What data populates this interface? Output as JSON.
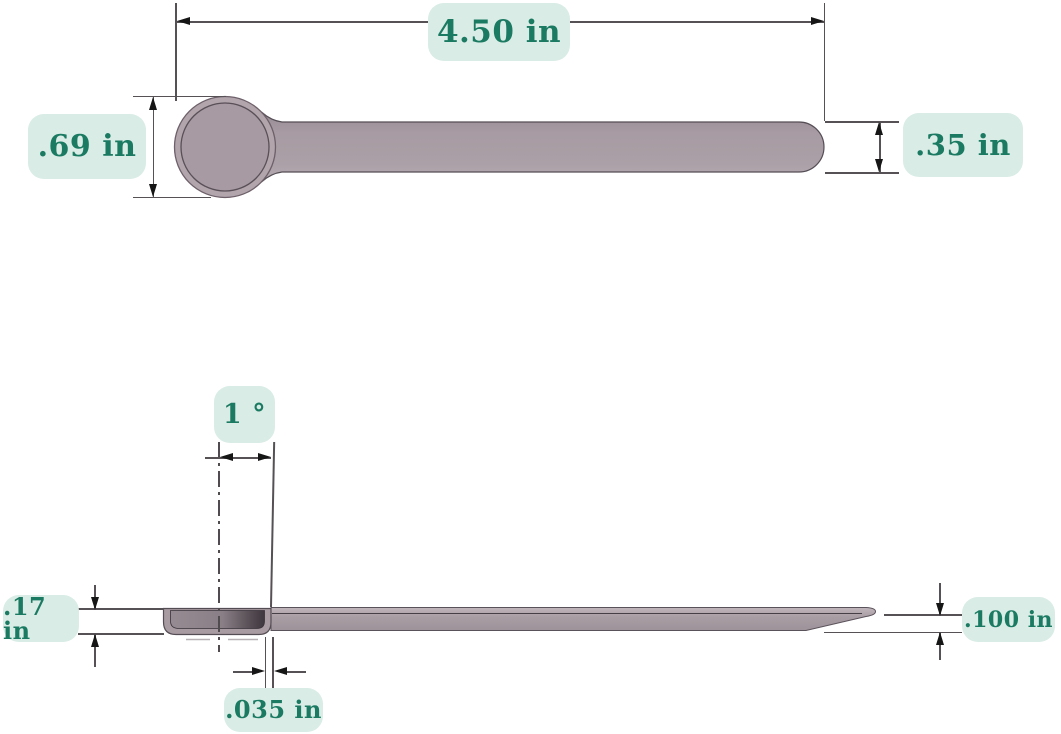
{
  "drawing": {
    "title": "measuring scoop dimensioned drawing",
    "type": "technical-dimension-diagram",
    "units": "in"
  },
  "views": {
    "top": {
      "length": "4.50 in",
      "bowl_diameter": ".69 in",
      "handle_width": ".35 in"
    },
    "side": {
      "draft_angle": "1 °",
      "bowl_depth": ".17 in",
      "lip_thickness": ".035 in",
      "handle_thickness": ".100 in"
    }
  },
  "style": {
    "label_background": "#d9ece5",
    "label_text_color": "#1b7a62",
    "spoon_fill": "#a89aa2",
    "spoon_outline": "#5a525a",
    "dimension_line_color": "#555155",
    "arrow_color": "#161616",
    "page_background": "#ffffff"
  }
}
